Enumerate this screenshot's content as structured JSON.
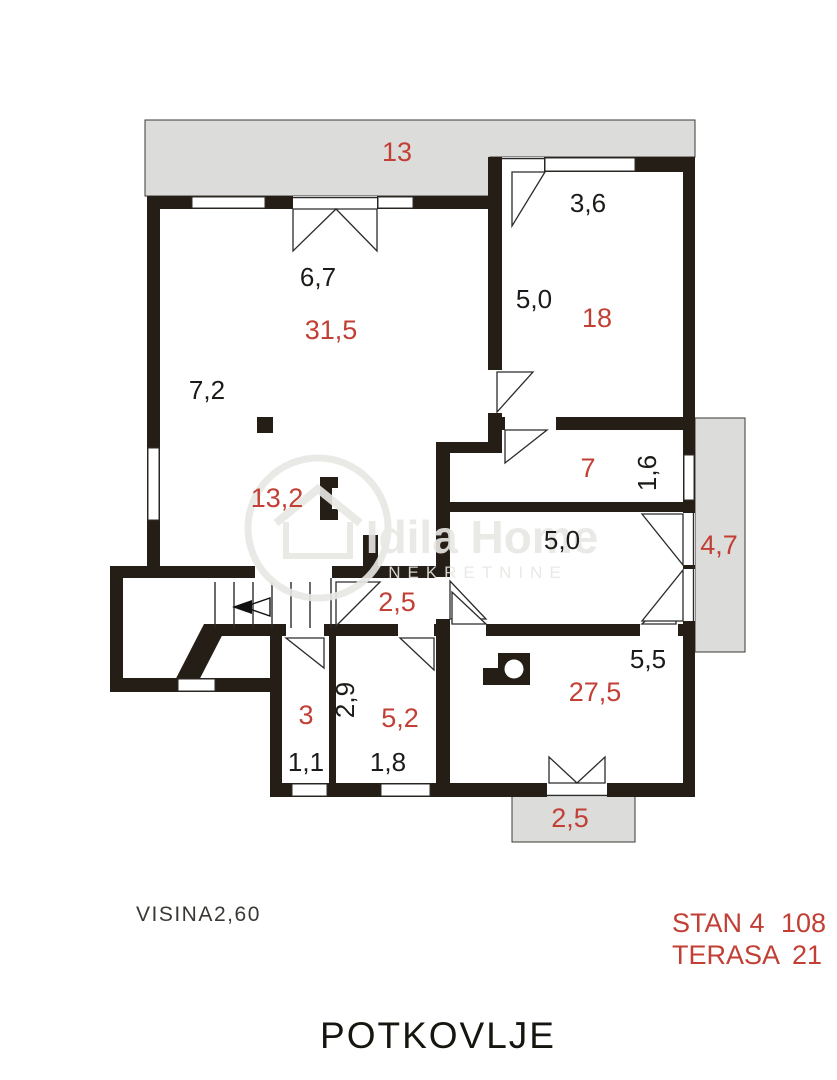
{
  "plan": {
    "title": "POTKOVLJE",
    "height_note": {
      "label": "VISINA",
      "value": "2,60"
    },
    "summary": [
      {
        "label": "STAN 4",
        "value": "108"
      },
      {
        "label": "TERASA",
        "value": "21"
      }
    ],
    "watermark": {
      "name": "Idila Home",
      "subtitle": "NEKRETNINE"
    },
    "colors": {
      "wall": "#251e17",
      "red_text": "#c13f35",
      "black_text": "#1d1b18",
      "terrace_gray": "#dcdcda"
    },
    "dims": {
      "terrace_top": "13",
      "living_top_width": "6,7",
      "living_area": "31,5",
      "living_left_depth": "7,2",
      "living_lower_area": "13,2",
      "room18_top_width": "3,6",
      "room18_depth": "5,0",
      "room18_area": "18",
      "room7_area": "7",
      "room7_niche_depth": "1,6",
      "hall_width": "5,0",
      "balcony_right_area": "4,7",
      "inner_hall_area": "2,5",
      "room27_width": "5,5",
      "room27_area": "27,5",
      "room3_area": "3",
      "room3_width": "1,1",
      "room52_depth": "2,9",
      "room52_area": "5,2",
      "room52_width": "1,8",
      "balcony_bottom_area": "2,5"
    }
  }
}
